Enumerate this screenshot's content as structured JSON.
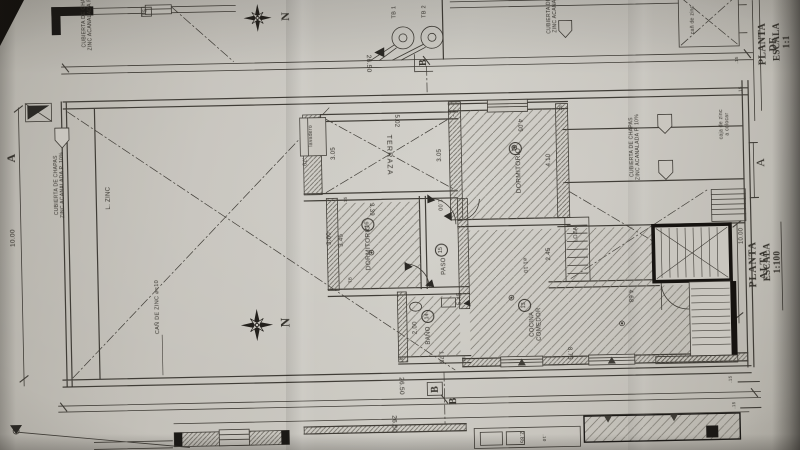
{
  "photo_colors": {
    "paper": "#c6c3bc",
    "ink": "#403d37",
    "heavy_wall": "#161310"
  },
  "titles": {
    "sheet_title": "PLANTA ALTA",
    "sheet_scale": "ESCALA 1:100",
    "corner_title": "PLANTA DE",
    "corner_scale": "ESCALA 1:1"
  },
  "labels": [
    {
      "name": "title-planta-alta",
      "text": "PLANTA ALTA",
      "x": 758,
      "y": 272,
      "rot": -90,
      "fs": 10,
      "bold": true,
      "serif": true,
      "ls": 1
    },
    {
      "name": "title-escala-1100",
      "text": "ESCALA 1:100",
      "x": 771,
      "y": 270,
      "rot": -90,
      "fs": 9,
      "bold": true,
      "serif": true
    },
    {
      "name": "title-planta-de",
      "text": "PLANTA DE",
      "x": 772,
      "y": 52,
      "rot": -90,
      "fs": 10,
      "bold": true,
      "serif": true
    },
    {
      "name": "title-escala-11",
      "text": "ESCALA 1:1",
      "x": 785,
      "y": 50,
      "rot": -90,
      "fs": 9,
      "bold": true,
      "serif": true
    },
    {
      "name": "north-label-top",
      "text": "N",
      "x": 290,
      "y": 14,
      "rot": -90,
      "fs": 12,
      "bold": true,
      "serif": true
    },
    {
      "name": "north-label-mid",
      "text": "N",
      "x": 284,
      "y": 320,
      "rot": -90,
      "fs": 13,
      "bold": true,
      "serif": true
    },
    {
      "name": "label-cubierta-left",
      "text": "CUBIERTA DE CHAPAS\nZINC ACANALADA P. 10%",
      "x": 61,
      "y": 178,
      "rot": -90,
      "fs": 5
    },
    {
      "name": "label-cubierta-top-left",
      "text": "CUBIERTA DE CHAPAS\nZINC ACANALADA P. 10%",
      "x": 92,
      "y": 11,
      "rot": -90,
      "fs": 5
    },
    {
      "name": "label-cubierta-right",
      "text": "CUBIERTA DE CHAPAS\nZINC ACANALADA P. 10%",
      "x": 637,
      "y": 152,
      "rot": -90,
      "fs": 5
    },
    {
      "name": "label-cubierta-top-right",
      "text": "CUBIERTA DE C\nZINC ACANALA",
      "x": 557,
      "y": 16,
      "rot": -90,
      "fs": 5
    },
    {
      "name": "label-l-zinc",
      "text": "L. ZINC",
      "x": 110,
      "y": 192,
      "rot": -90,
      "fs": 6
    },
    {
      "name": "label-can-de-zinc",
      "text": "CAÑ DE ZINC ⌀=10",
      "x": 156,
      "y": 302,
      "rot": -90,
      "fs": 5.5
    },
    {
      "name": "label-caja-zinc",
      "text": "caja de zinc\na colocar",
      "x": 727,
      "y": 131,
      "rot": -90,
      "fs": 5
    },
    {
      "name": "label-can-zinc-top",
      "text": "cañ de zinc",
      "x": 698,
      "y": 26,
      "rot": -90,
      "fs": 5
    },
    {
      "name": "room-terraza",
      "text": "TERRAZA",
      "x": 390,
      "y": 155,
      "rot": 90,
      "fs": 7,
      "ls": 1.2
    },
    {
      "name": "room-dormitorio-19",
      "text": "DORMITORIO",
      "x": 520,
      "y": 173,
      "rot": -90,
      "fs": 6.5
    },
    {
      "name": "room-number-19",
      "text": "19",
      "x": 517,
      "y": 151,
      "rot": -90,
      "fs": 5.5,
      "circled": true
    },
    {
      "name": "room-dormitorio-16",
      "text": "DORMITORIO",
      "x": 368,
      "y": 247,
      "rot": -90,
      "fs": 6.5
    },
    {
      "name": "room-number-16",
      "text": "16",
      "x": 368,
      "y": 224,
      "rot": -90,
      "fs": 5.5,
      "circled": true
    },
    {
      "name": "room-paso",
      "text": "PASO",
      "x": 444,
      "y": 267,
      "rot": -90,
      "fs": 6
    },
    {
      "name": "room-number-15",
      "text": "15",
      "x": 441,
      "y": 251,
      "rot": -90,
      "fs": 5.5,
      "circled": true
    },
    {
      "name": "room-bano",
      "text": "BAÑO",
      "x": 427,
      "y": 336,
      "rot": -90,
      "fs": 6
    },
    {
      "name": "room-number-14",
      "text": "14",
      "x": 426,
      "y": 317,
      "rot": -90,
      "fs": 5.5,
      "circled": true
    },
    {
      "name": "room-cocina-comedor",
      "text": "COCINA\nCOMEDOR",
      "x": 534,
      "y": 327,
      "rot": -90,
      "fs": 6
    },
    {
      "name": "room-number-13",
      "text": "13",
      "x": 523,
      "y": 308,
      "rot": -90,
      "fs": 5.5,
      "circled": true
    },
    {
      "name": "label-loza",
      "text": "LOZA",
      "x": 576,
      "y": 238,
      "rot": -90,
      "fs": 5.5
    },
    {
      "name": "label-lavadero",
      "text": "lavadero",
      "x": 314,
      "y": 134,
      "rot": -90,
      "fs": 5
    },
    {
      "name": "dim-26-50-top",
      "text": "26.50",
      "x": 372,
      "y": 63,
      "rot": 90,
      "fs": 6.5
    },
    {
      "name": "dim-26-50-bottom-1",
      "text": "26.50",
      "x": 398,
      "y": 386,
      "rot": 90,
      "fs": 6.5
    },
    {
      "name": "dim-26-50-bottom-2",
      "text": "26.50",
      "x": 390,
      "y": 424,
      "rot": 90,
      "fs": 6.5
    },
    {
      "name": "dim-10-00-left",
      "text": "10.00",
      "x": 13,
      "y": 230,
      "rot": -90,
      "fs": 6.5
    },
    {
      "name": "dim-10-00-stairs",
      "text": "10.00",
      "x": 742,
      "y": 243,
      "rot": -90,
      "fs": 6
    },
    {
      "name": "dim-5-02",
      "text": "5.02",
      "x": 398,
      "y": 121,
      "rot": 90,
      "fs": 6
    },
    {
      "name": "dim-3-05-terraza",
      "text": "3.05",
      "x": 336,
      "y": 152,
      "rot": -90,
      "fs": 6
    },
    {
      "name": "dim-0-70",
      "text": ".70",
      "x": 305,
      "y": 160,
      "rot": 90,
      "fs": 5.5
    },
    {
      "name": "dim-3-05-dorm19",
      "text": "3.05",
      "x": 442,
      "y": 156,
      "rot": -90,
      "fs": 6
    },
    {
      "name": "dim-4-05",
      "text": "4.05",
      "x": 521,
      "y": 128,
      "rot": 90,
      "fs": 6
    },
    {
      "name": "dim-4-10",
      "text": "4.10",
      "x": 551,
      "y": 163,
      "rot": -90,
      "fs": 6
    },
    {
      "name": "dim-3-39",
      "text": "3.39",
      "x": 371,
      "y": 209,
      "rot": 90,
      "fs": 6
    },
    {
      "name": "dim-3-45",
      "text": "3.45",
      "x": 342,
      "y": 239,
      "rot": -90,
      "fs": 6
    },
    {
      "name": "dim-3-60",
      "text": "3.60",
      "x": 330,
      "y": 237,
      "rot": -90,
      "fs": 6
    },
    {
      "name": "dim-1-00",
      "text": "1.00",
      "x": 440,
      "y": 206,
      "rot": 90,
      "fs": 5.5
    },
    {
      "name": "dim-2-45",
      "text": "2.45",
      "x": 549,
      "y": 257,
      "rot": -90,
      "fs": 6
    },
    {
      "name": "dim-5-45",
      "text": "5.45",
      "x": 459,
      "y": 300,
      "rot": -90,
      "fs": 6
    },
    {
      "name": "dim-2-00",
      "text": "2.00",
      "x": 414,
      "y": 328,
      "rot": -90,
      "fs": 6
    },
    {
      "name": "dim-1-75",
      "text": "1.75",
      "x": 438,
      "y": 358,
      "rot": 90,
      "fs": 5.5
    },
    {
      "name": "dim-8-75",
      "text": "8.75",
      "x": 566,
      "y": 357,
      "rot": 90,
      "fs": 6
    },
    {
      "name": "dim-4-68",
      "text": "4.68",
      "x": 628,
      "y": 301,
      "rot": 90,
      "fs": 6
    },
    {
      "name": "dim-dia-1-10",
      "text": "⌀1.10",
      "x": 524,
      "y": 268,
      "rot": 90,
      "fs": 5.5
    },
    {
      "name": "dim-2-85",
      "text": "2.85",
      "x": 517,
      "y": 440,
      "rot": 90,
      "fs": 5.5
    },
    {
      "name": "dim-0-10",
      "text": ".10",
      "x": 540,
      "y": 441,
      "rot": 90,
      "fs": 4.5
    },
    {
      "name": "dim-15-a",
      "text": ".15",
      "x": 563,
      "y": 112,
      "rot": -90,
      "fs": 4.5
    },
    {
      "name": "dim-15-b",
      "text": ".15",
      "x": 346,
      "y": 199,
      "rot": -90,
      "fs": 4.5
    },
    {
      "name": "dim-15-c",
      "text": ".15",
      "x": 399,
      "y": 361,
      "rot": -90,
      "fs": 4.5
    },
    {
      "name": "dim-15-d",
      "text": ".15",
      "x": 461,
      "y": 361,
      "rot": -90,
      "fs": 4.5
    },
    {
      "name": "dim-15-e",
      "text": ".15",
      "x": 740,
      "y": 67,
      "rot": -90,
      "fs": 4.5
    },
    {
      "name": "dim-15-f",
      "text": ".15",
      "x": 743,
      "y": 97,
      "rot": -90,
      "fs": 4.5
    },
    {
      "name": "dim-15-g",
      "text": ".15",
      "x": 727,
      "y": 386,
      "rot": -90,
      "fs": 4.5
    },
    {
      "name": "dim-15-h",
      "text": ".15",
      "x": 730,
      "y": 412,
      "rot": -90,
      "fs": 4.5
    },
    {
      "name": "label-tb-1",
      "text": "TB 1",
      "x": 399,
      "y": 12,
      "rot": -90,
      "fs": 5.5
    },
    {
      "name": "label-tb-2",
      "text": "TB 2",
      "x": 429,
      "y": 12,
      "rot": -90,
      "fs": 5.5
    },
    {
      "name": "label-ts",
      "text": "TS",
      "x": 151,
      "y": 7,
      "rot": -90,
      "fs": 5
    },
    {
      "name": "label-tb-small",
      "text": "TB",
      "x": 349,
      "y": 279,
      "rot": -90,
      "fs": 4.5
    },
    {
      "name": "section-a-left",
      "text": "A",
      "x": 13,
      "y": 150,
      "rot": -90,
      "fs": 12,
      "bold": true,
      "serif": true
    },
    {
      "name": "section-a-right",
      "text": "A",
      "x": 762,
      "y": 170,
      "rot": -90,
      "fs": 12,
      "serif": true
    },
    {
      "name": "section-b-top",
      "text": "B",
      "x": 427,
      "y": 63,
      "rot": -90,
      "fs": 10,
      "bold": true,
      "serif": true
    },
    {
      "name": "section-b-bottom-1",
      "text": "B",
      "x": 432,
      "y": 390,
      "rot": -90,
      "fs": 10,
      "bold": true,
      "serif": true
    },
    {
      "name": "section-b-bottom-2",
      "text": "B",
      "x": 450,
      "y": 402,
      "rot": -90,
      "fs": 10,
      "bold": true,
      "serif": true
    }
  ]
}
